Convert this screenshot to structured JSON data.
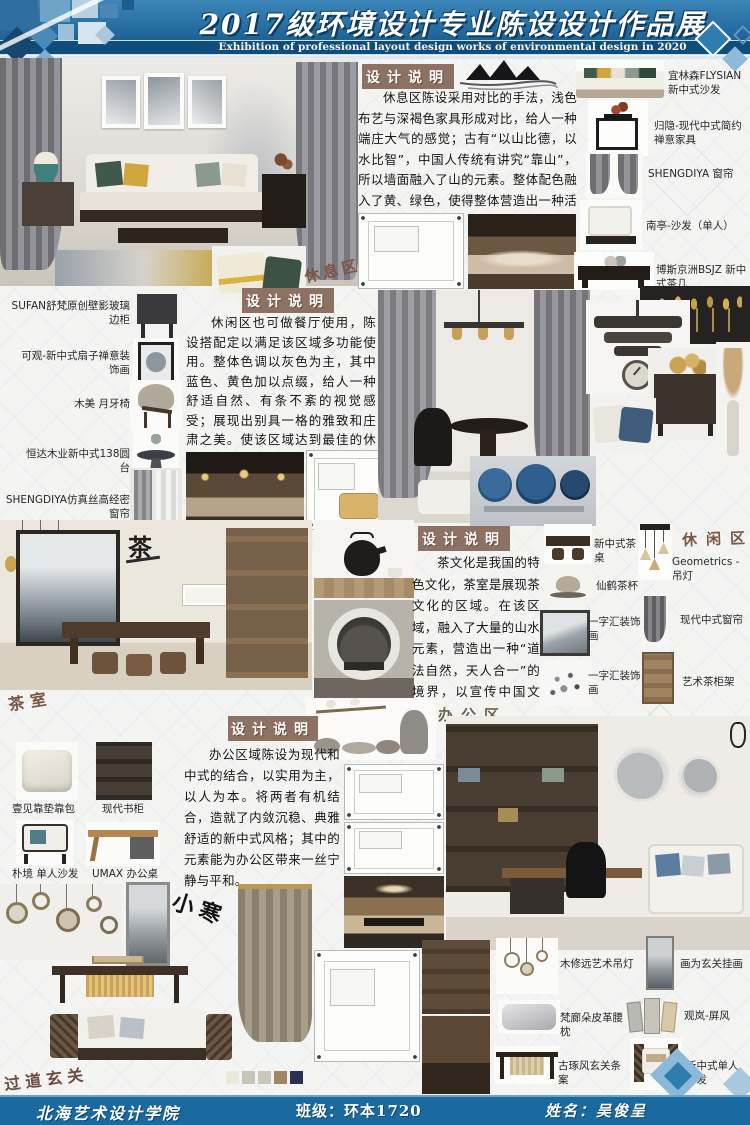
{
  "header": {
    "title": "2017级环境设计专业陈设设计作品展",
    "subtitle": "Exhibition of professional layout design works of environmental design in 2020"
  },
  "footer": {
    "school": "北海艺术设计学院",
    "class_label": "班级：环本1720",
    "name_label": "姓名：吴俊呈"
  },
  "colors": {
    "banner_blue": "#1d6296",
    "footer_blue": "#1a6aa0",
    "badge_brown": "#8d7163"
  },
  "swatches": [
    "#ebe8dc",
    "#c7c5b6",
    "#cbc8b9",
    "#a28467",
    "#2a3150"
  ],
  "sections": {
    "rest": {
      "zone": "休息区",
      "note_title": "设计说明",
      "paragraph": "休息区陈设采用对比的手法，浅色布艺与深褐色家具形成对比，给人一种端庄大气的感觉；古有“以山比德，以水比智”，中国人传统有讲究“靠山”，所以墙面融入了山的元素。整体配色融入了黄、绿色，使得整体营造出一种活跃的气氛。",
      "products": [
        "宜林森FLYSIAN 新中式沙发",
        "归隐-现代中式简约禅意家具",
        "SHENGDIYA 窗帘",
        "南亭-沙发（单人）",
        "博斯京洲BSJZ 新中式茶几"
      ]
    },
    "leisure": {
      "zone": "休闲区",
      "note_title": "设计说明",
      "paragraph": "休闲区也可做餐厅使用，陈设搭配定以满足该区域多功能使用。整体色调以灰色为主，其中蓝色、黄色加以点缀，给人一种舒适自然、有条不紊的视觉感受；展现出别具一格的雅致和庄肃之美。使该区域达到最佳的休闲、放松的目的。",
      "products_left": [
        "SUFAN舒梵原创壁影玻璃边柜",
        "可观-新中式扇子禅意装饰画",
        "木美 月牙椅",
        "恒达木业新中式138圆台",
        "SHENGDIYA仿真丝高经密窗帘"
      ]
    },
    "tea": {
      "zone": "茶室",
      "glyph": "茶",
      "note_title": "设计说明",
      "paragraph": "茶文化是我国的特色文化，茶室是展现茶文化的区域。在该区域，融入了大量的山水元素，营造出一种“道法自然，天人合一”的境界，以宣传中国文化。",
      "products": [
        "新中式茶桌",
        "Geometrics - 吊灯",
        "仙鹤茶杯",
        "一字汇装饰画",
        "现代中式窗帘",
        "一字汇装饰画",
        "艺术茶柜架"
      ]
    },
    "office": {
      "zone": "办公区",
      "note_title": "设计说明",
      "paragraph": "办公区域陈设为现代和中式的结合，以实用为主，以人为本。将两者有机结合，造就了内敛沉稳、典雅舒适的新中式风格；其中的元素能为办公区带来一丝宁静与平和。",
      "products_left": [
        "壹见靠垫靠包",
        "现代书柜",
        "朴境 单人沙发",
        "UMAX 办公桌"
      ]
    },
    "hallway": {
      "zone": "过道玄关",
      "calligraphy": "小寒",
      "products": [
        "木修远艺术吊灯",
        "画为玄关挂画",
        "梵廊朵皮革腰枕",
        "观岚-屏风",
        "古琢风玄关条案",
        "新中式单人沙发"
      ]
    }
  }
}
